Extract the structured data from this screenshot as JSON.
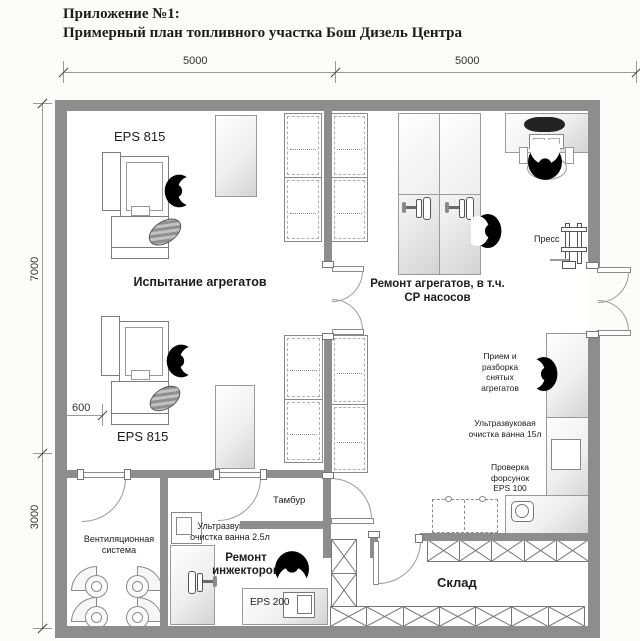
{
  "header": {
    "line1": "Приложение №1:",
    "line2": "Примерный план топливного участка Бош Дизель Центра"
  },
  "dimensions": {
    "top_left": "5000",
    "top_right": "5000",
    "side_upper": "7000",
    "side_lower": "3000",
    "offset": "600"
  },
  "rooms": {
    "testing": "Испытание агрегатов",
    "repair_l1": "Ремонт агрегатов, в т.ч.",
    "repair_l2": "СР насосов",
    "tambour": "Тамбур",
    "ventilation": "Вентиляционная система",
    "injectors_l1": "Ремонт",
    "injectors_l2": "инжекторов",
    "warehouse": "Склад"
  },
  "equipment": {
    "eps815_top": "EPS 815",
    "eps815_bottom": "EPS 815",
    "press": "Пресс",
    "intake": "Прием и разборка снятых агрегатов",
    "ultrasonic_15": "Ультразвуковая очистка ванна 15л",
    "eps100": "Проверка форсунок EPS 100",
    "ultrasonic_25": "Ультразвуковая очистка ванна 2.5л",
    "eps200": "EPS 200"
  },
  "accent_colors": {
    "wall": "#8d8d8d",
    "figure": "#000000"
  }
}
